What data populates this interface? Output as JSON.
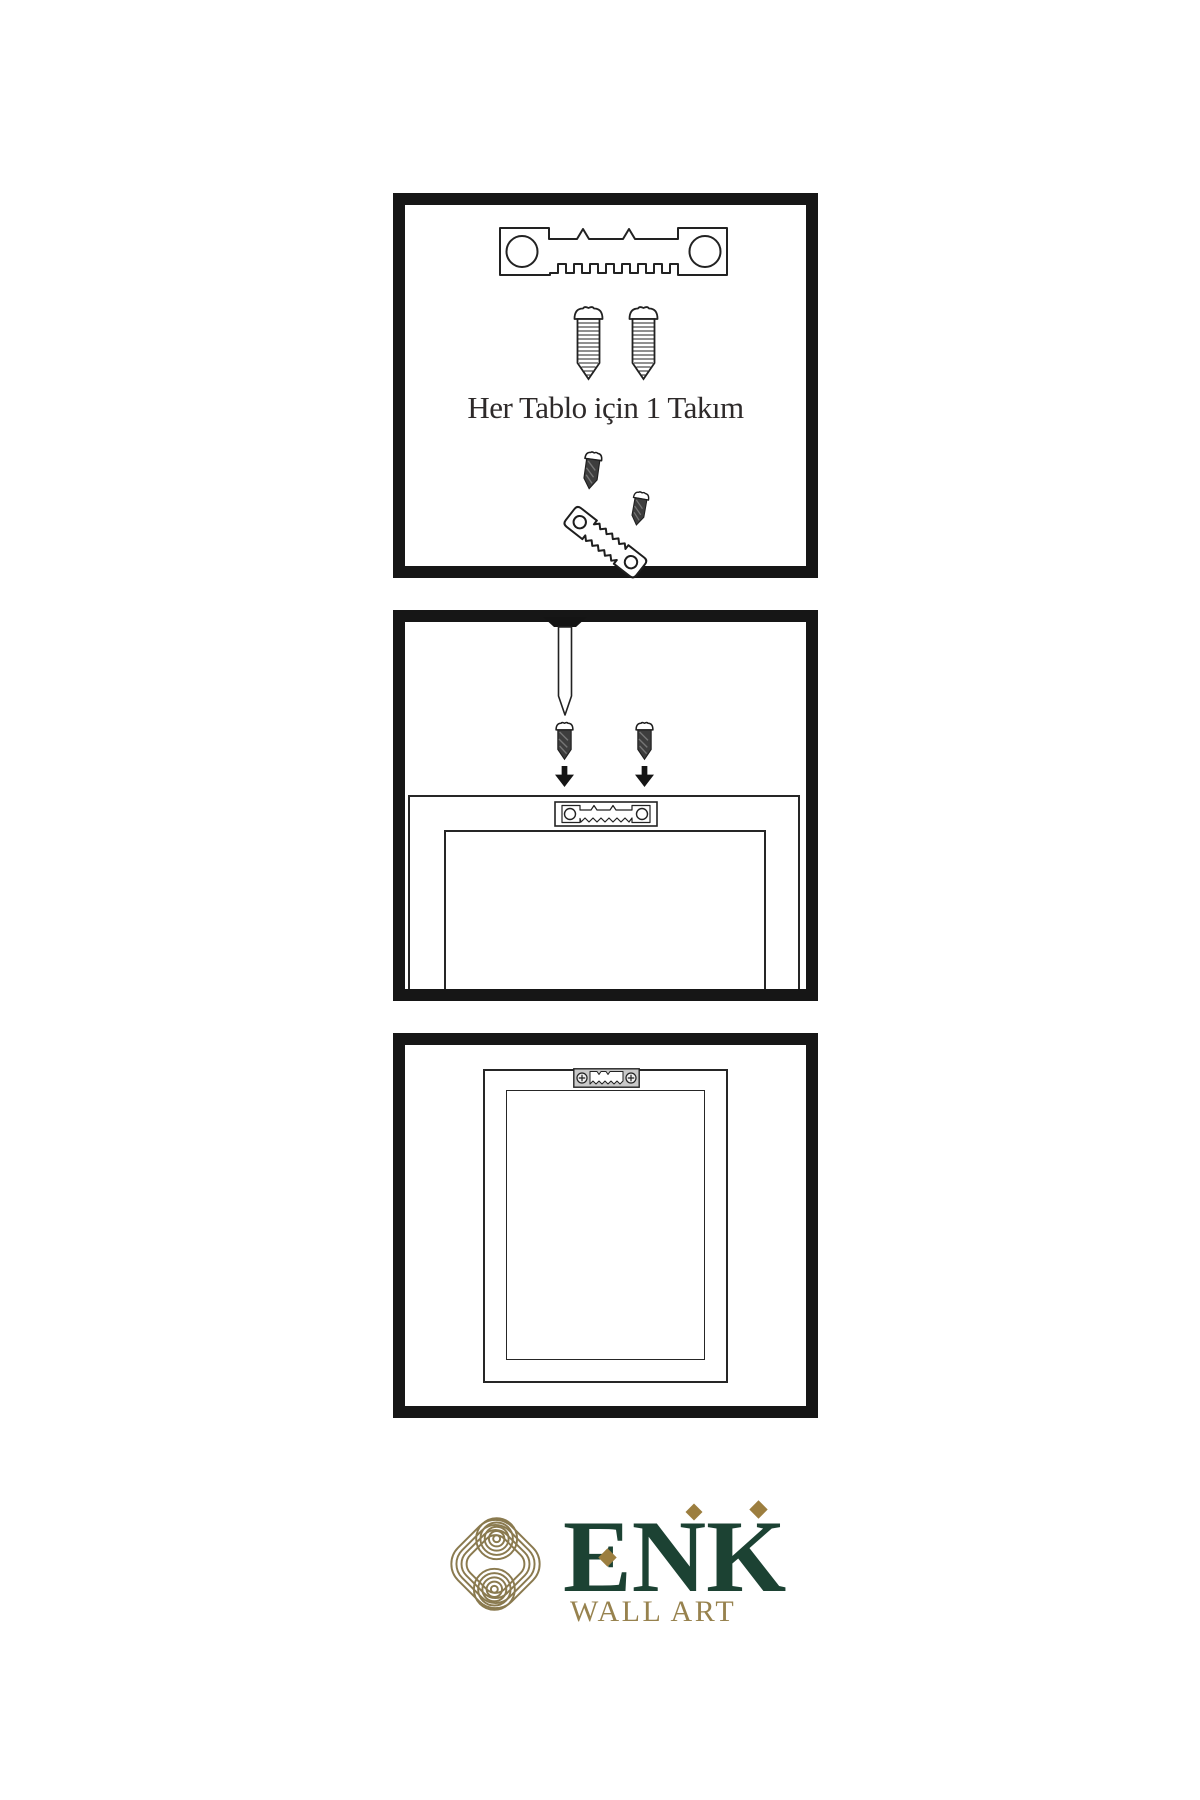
{
  "caption": {
    "text": "Her Tablo için 1 Takım"
  },
  "logo": {
    "wordmark": "ENK",
    "subtitle": "WALL ART",
    "colors": {
      "green": "#1c4233",
      "gold": "#8a7a4f",
      "diamond_gold": "#9c7e3f"
    }
  },
  "colors": {
    "background": "#ffffff",
    "panel_border": "#161616",
    "line_outline": "#222222",
    "screw_dark_fill": "#3d3d3d",
    "hanger_plate_gray": "#c9c9c9",
    "caption_text": "#2e2a2a"
  },
  "icons": [
    "sawtooth-hanger-icon",
    "screw-icon",
    "dark-screw-icon",
    "nail-icon",
    "arrow-down-icon",
    "sawtooth-hanger-plate-icon",
    "sawtooth-hanger-mounted-icon",
    "knot-logo-icon"
  ]
}
